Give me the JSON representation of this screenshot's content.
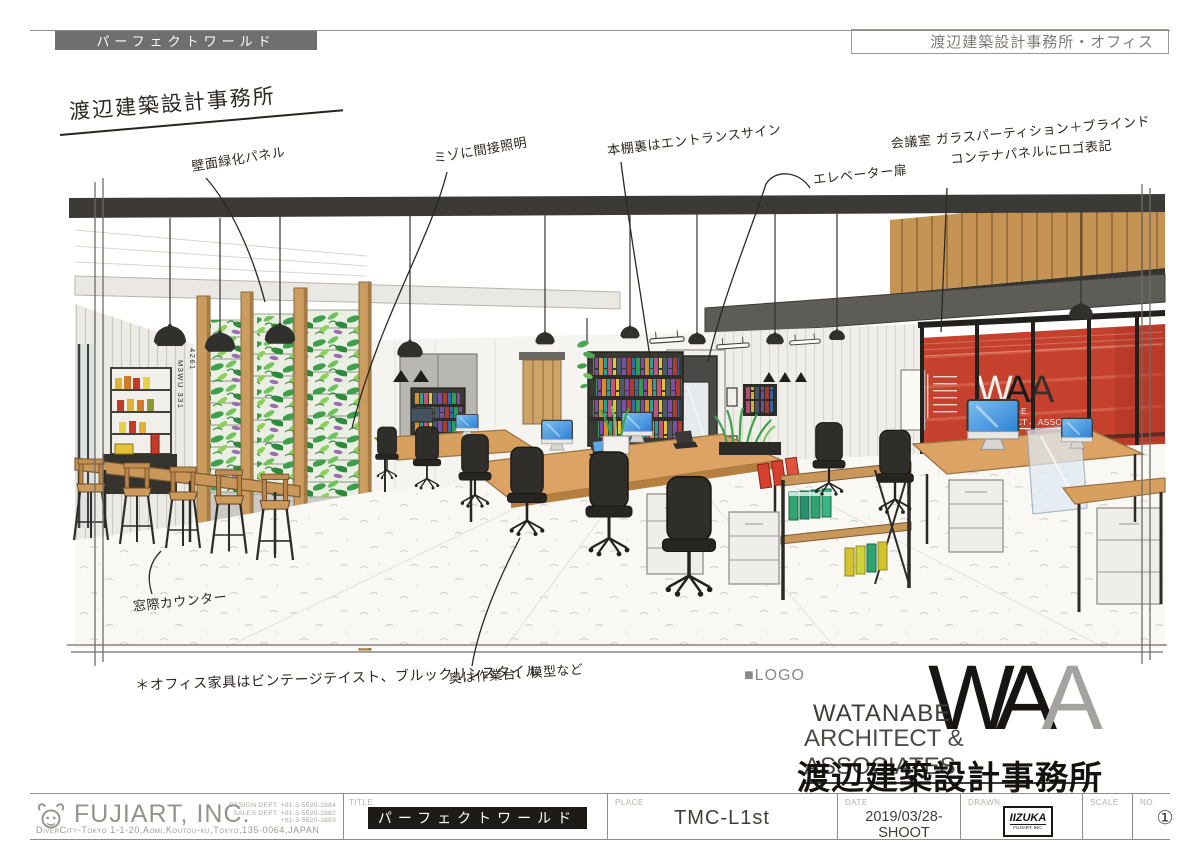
{
  "header": {
    "project_title": "パーフェクトワールド",
    "sheet_title": "渡辺建築設計事務所・オフィス"
  },
  "sketch": {
    "hand_title": "渡辺建築設計事務所",
    "annotations": {
      "green_wall": "壁面緑化パネル",
      "groove_light": "ミゾに間接照明",
      "bookshelf": "本棚裏はエントランスサイン",
      "elevator": "エレベーター扉",
      "meeting_line1": "会議室 ガラスパーティション＋ブラインド",
      "meeting_line2": "コンテナパネルにロゴ表記",
      "window_counter": "窓際カウンター",
      "work_table": "奥は作業台、模型など",
      "furniture_note": "＊オフィス家具はビンテージテイスト、ブルックリンスタイル"
    },
    "container_codes": {
      "left": "M3WU 331",
      "right": "4261"
    },
    "wall_logo": {
      "w": "W",
      "a1": "A",
      "a2": "A",
      "line1": "WATANABE",
      "line2": "ARCHITECT & ASSOCIATES"
    }
  },
  "logo_block": {
    "placeholder": "■LOGO",
    "mark": {
      "w": "W",
      "a1": "A",
      "a2": "A"
    },
    "name_line1": "WATANABE",
    "name_line2": "ARCHITECT & ASSOCIATES",
    "name_jp": "渡辺建築設計事務所"
  },
  "title_block": {
    "company": "FUJIART, INC.",
    "design_dept": "DESIGN DEPT.  +81-3-5520-1884",
    "sales_dept": "SALES DEPT.  +81-3-5520-1882",
    "phone_extra": "+81-3-5520-1883",
    "address": "DiverCity-Tokyo 1-1-20,Aomi,Koutou-ku,Tokyo,135-0064,JAPAN",
    "title_label": "TITLE",
    "title_value": "パーフェクトワールド",
    "place_label": "PLACE",
    "place_value": "TMC-L1st",
    "date_label": "DATE",
    "date_value": "2019/03/28- SHOOT",
    "drawn_label": "DRAWN",
    "drawn_stamp_name": "IIZUKA",
    "drawn_stamp_company": "FUJIART, INC.",
    "scale_label": "SCALE",
    "no_label": "NO.",
    "no_value": "①"
  },
  "colors": {
    "accent_red": "#c6402e",
    "wood": "#cb9a5c",
    "foliage_green": "#46a14b",
    "header_gray": "#6f6f6d",
    "ink": "#2a2822"
  }
}
